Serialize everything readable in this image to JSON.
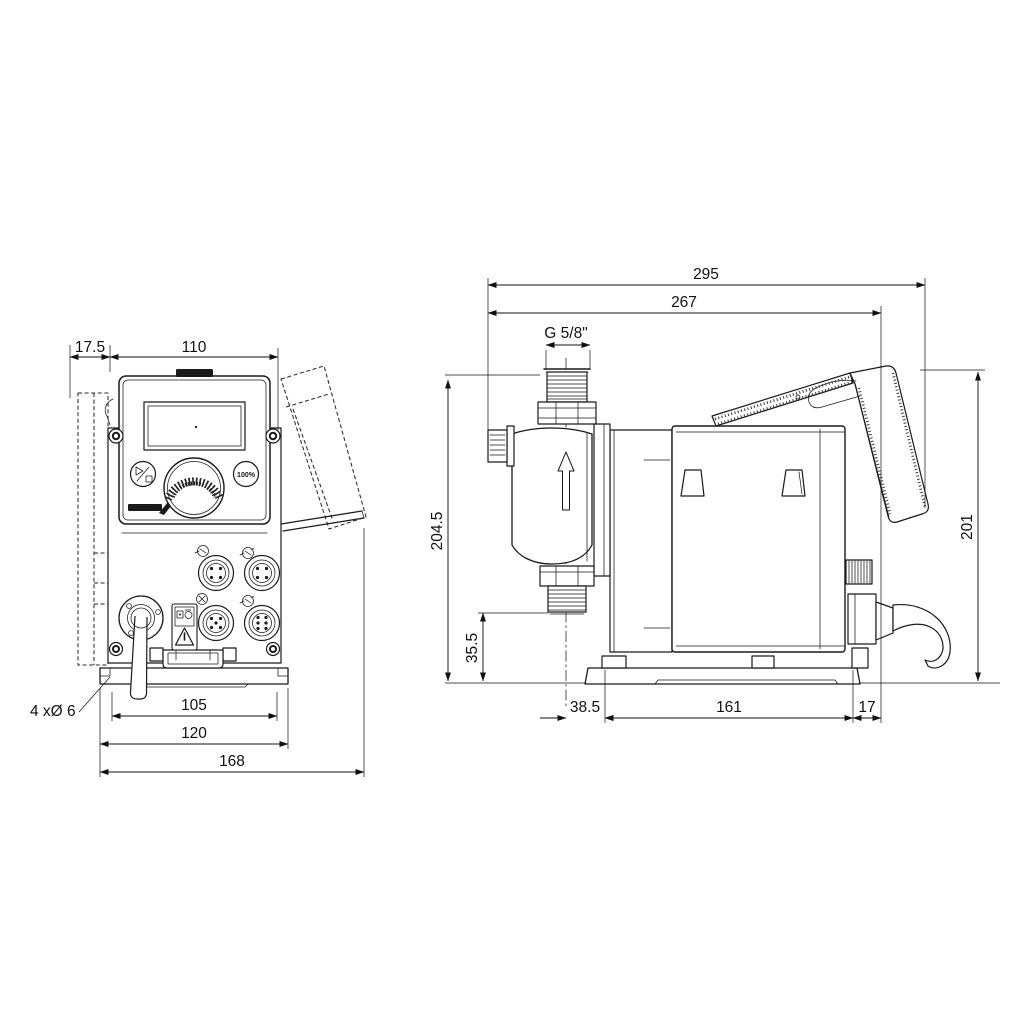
{
  "title": "Dosing pump dimensional drawing",
  "front_view": {
    "dim_offset_left": "17.5",
    "dim_width": "110",
    "label_holes": "4 xØ 6",
    "dim_base_inner": "105",
    "dim_base_outer": "120",
    "dim_total_width": "168",
    "button_100_label": "100%"
  },
  "side_view": {
    "dim_total_depth": "295",
    "dim_body_depth": "267",
    "dim_thread": "G 5/8\"",
    "dim_height": "204.5",
    "dim_outlet_height": "35.5",
    "dim_rear_height": "201",
    "dim_front_offset": "38.5",
    "dim_base_length": "161",
    "dim_rear_offset": "17"
  },
  "icon_names": [
    "grundfos-logo",
    "start-stop-icon",
    "click-wheel-knob",
    "hundred-percent-button",
    "warning-triangle-icon",
    "flow-direction-arrow-icon",
    "m12-connector-icon",
    "cable-gland-icon",
    "relay-connector-icons"
  ],
  "colors": {
    "line": "#1a1a1a",
    "background": "#ffffff"
  }
}
